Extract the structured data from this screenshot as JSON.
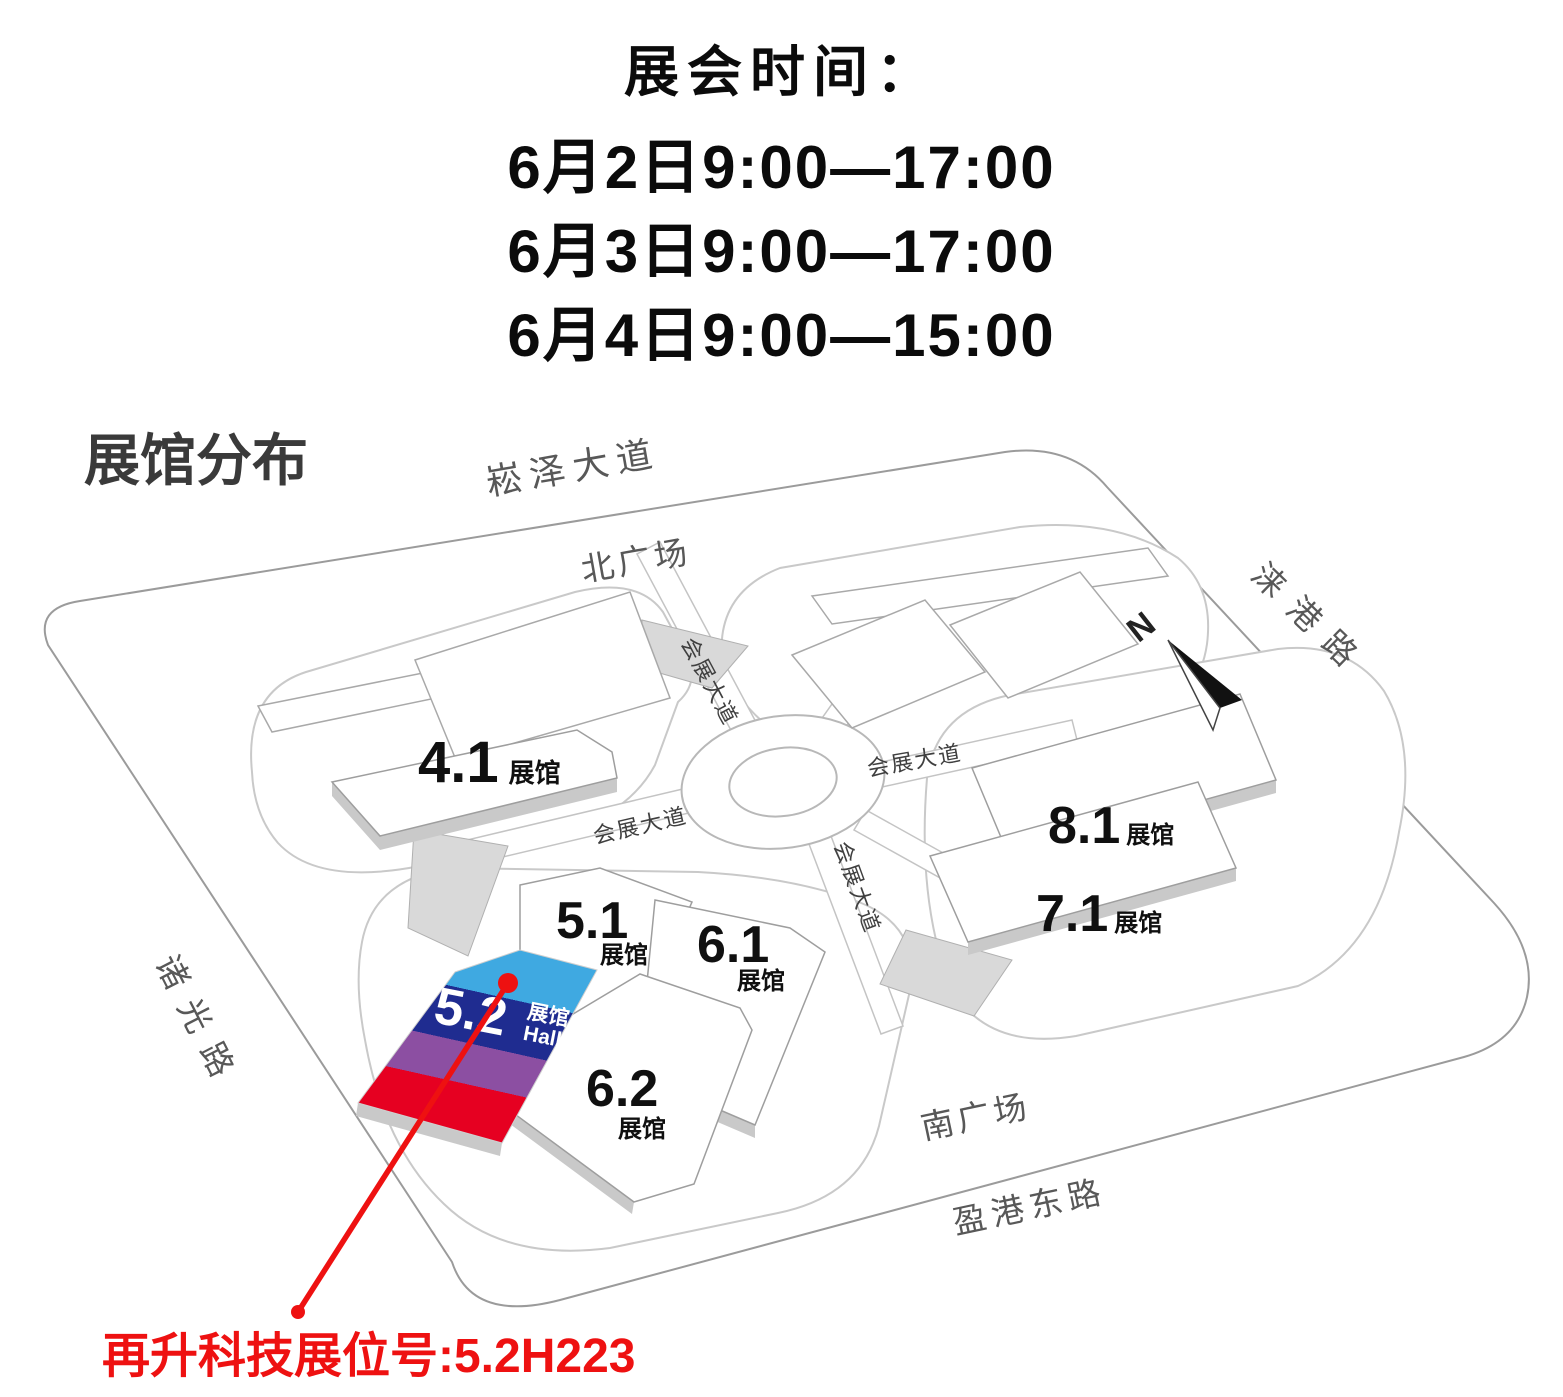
{
  "schedule": {
    "title": "展会时间：",
    "lines": [
      "6月2日9:00—17:00",
      "6月3日9:00—17:00",
      "6月4日9:00—15:00"
    ]
  },
  "map": {
    "title": "展馆分布",
    "compass": "N",
    "roads": {
      "songze_avenue": "崧泽大道",
      "laigang_road": "涞港路",
      "zhuguang_road": "诸光路",
      "yinggang_east_road": "盈港东路",
      "exhibition_avenue": "会展大道"
    },
    "plazas": {
      "north": "北广场",
      "south": "南广场"
    },
    "halls": {
      "h41": {
        "number": "4.1",
        "suffix": "展馆"
      },
      "h51": {
        "number": "5.1",
        "suffix": "展馆"
      },
      "h61": {
        "number": "6.1",
        "suffix": "展馆"
      },
      "h62": {
        "number": "6.2",
        "suffix": "展馆"
      },
      "h71": {
        "number": "7.1",
        "suffix": "展馆"
      },
      "h81": {
        "number": "8.1",
        "suffix": "展馆"
      },
      "h52": {
        "number": "5.2",
        "suffix": "展馆",
        "suffix_en": "Hall"
      }
    },
    "colors": {
      "hall52_blue": "#3FA9E1",
      "hall52_navy": "#1F2C90",
      "hall52_purple": "#8C4FA2",
      "hall52_red": "#E60021",
      "annotation_red": "#EE1111"
    }
  },
  "annotation": {
    "booth": "再升科技展位号:5.2H223"
  }
}
